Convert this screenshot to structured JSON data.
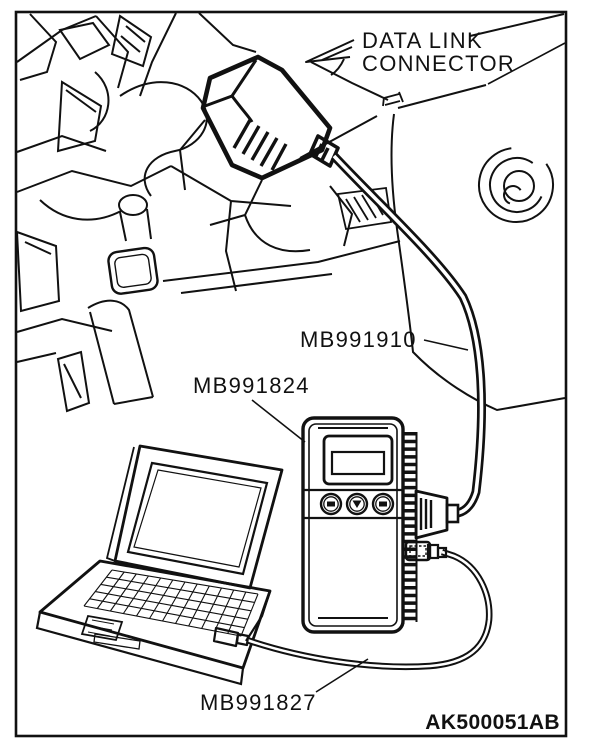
{
  "figure": {
    "id_code": "AK500051AB",
    "ink_color": "#111111",
    "background_color": "#ffffff",
    "description": "Service manual illustration: scan tool connection to vehicle data link connector"
  },
  "labels": {
    "data_link_line1": "DATA LINK",
    "data_link_line2": "CONNECTOR",
    "interface_cable_part": "MB991910",
    "vci_unit_part": "MB991824",
    "usb_cable_part": "MB991827"
  }
}
